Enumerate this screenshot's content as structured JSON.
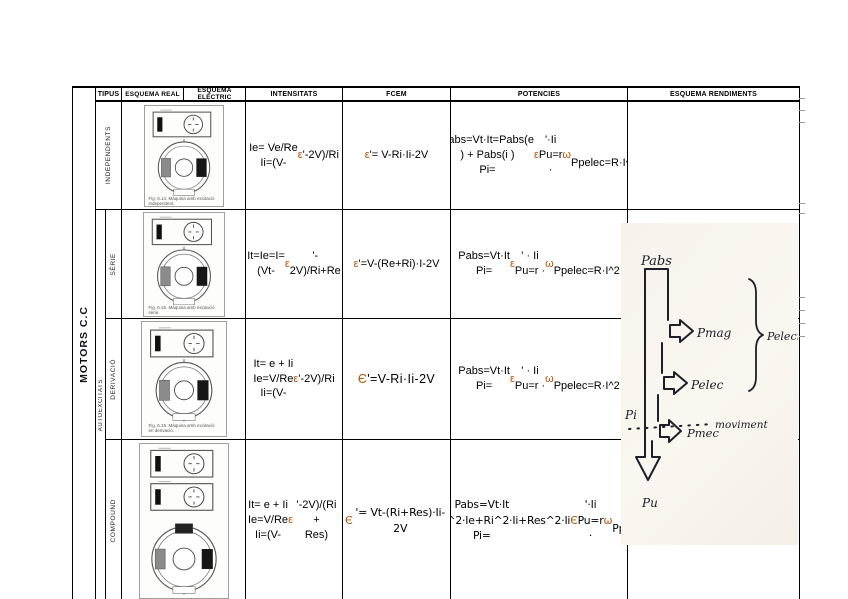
{
  "table": {
    "headers": {
      "tipus": "TIPUS",
      "esquema_real": "ESQUEMA REAL",
      "esquema_electric": "ESQUEMA ELÈCTRIC",
      "intensitats": "INTENSITATS",
      "fcem": "FCEM",
      "potencies": "POTENCIES",
      "esquema_rendiments": "ESQUEMA RENDIMENTS"
    },
    "group": {
      "motors": "MOTORS C.C",
      "autoexcitats": "AUTOEXCITATS"
    },
    "rows": [
      {
        "tipus": "INDEPENDENTS",
        "caption": "Fig. 6.14. Màquina amb excitació independent.",
        "intensitats": "Ie= Ve/Re\nIi=(V-ε'-2V)/Ri",
        "fcem": "ε'= V-Ri·Ii-2V",
        "potencies": "Pabs=Vt·It=Pabs(e ) + Pabs(i )\nPi=ε'·Ii\nPu=r · ω\nPpelec=R·I^2"
      },
      {
        "tipus": "SÈRIE",
        "caption": "Fig. 6.15. Màquina amb excitació sèrie.",
        "intensitats": "It=Ie=I=(Vt-ε'-\n2V)/Ri+Re",
        "fcem": "ε'=V-(Re+Ri)·I-2V",
        "potencies": "Pabs=Vt·It\nPi=ε' · Ii\nPu=r · ω\nPpelec=R·I^2"
      },
      {
        "tipus": "DERIVACIÓ",
        "caption": "Fig. 6.15. Màquina amb excitació en derivació.",
        "intensitats": "It= e + Ii\nIe=V/Re\nIi=(V-ε'-2V)/Ri",
        "fcem": "Є'=V-Ri·Ii-2V",
        "potencies": "Pabs=Vt·It\nPi=ε' · Ii\nPu=r · ω\nPpelec=R·I^2"
      },
      {
        "tipus": "COMPOUND",
        "caption": "Fig. 6.16. Màquina elèctrica amb excitació composta.",
        "intensitats": "It= e + Ii\nIe=V/Re\nIi=(V-ε'-2V)/(Ri +\nRes)",
        "fcem": "Є'= Vt-(Ri+Res)·Ii-2V",
        "potencies": "Pabs=Vt·It\nPabs=Red^2·Ie+Ri^2·Ii+Res^2·Ii\nPi=Є'·Ii\nPu=r · ω\nPpelec=R·I^2"
      }
    ]
  },
  "rendiments_diagram": {
    "pabs": "Pabs",
    "pmag": "Pmag",
    "pelecmag": "Pelecmag",
    "pelec": "Pelec",
    "pi": "Pi",
    "moviment": "moviment",
    "pmec": "Pmec",
    "pu": "Pu"
  },
  "colors": {
    "greek_symbol": "#b45309",
    "border": "#000000",
    "scan_background": "#f6f1ea"
  }
}
